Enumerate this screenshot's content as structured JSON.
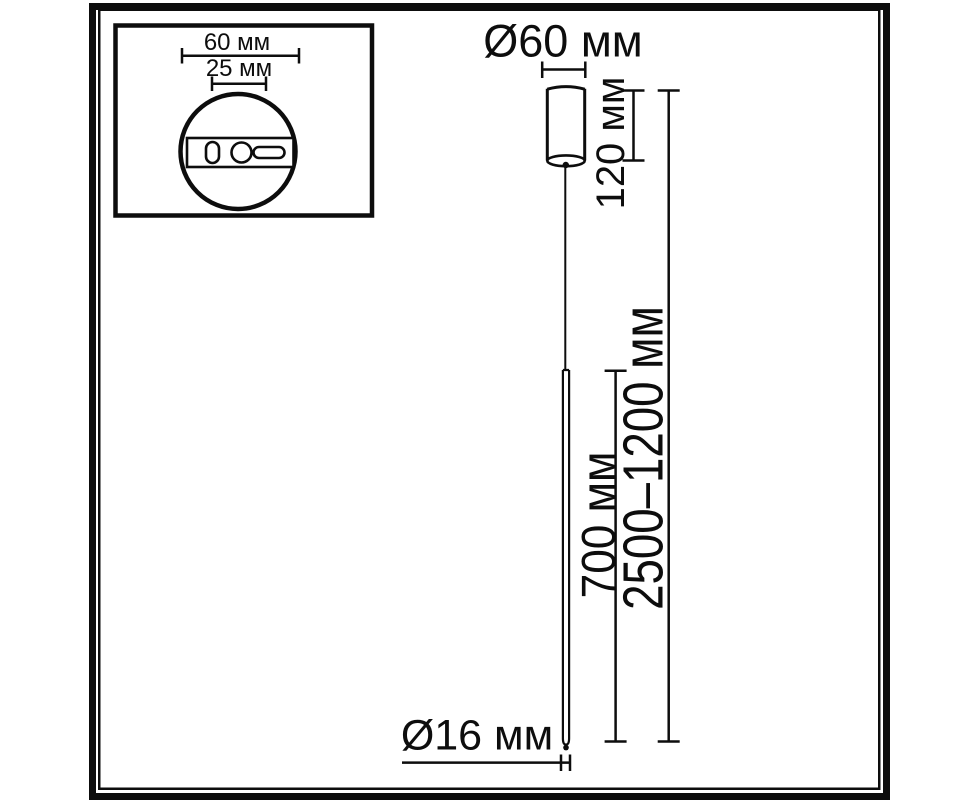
{
  "colors": {
    "ink": "#0d0d0d",
    "background": "#ffffff"
  },
  "detail_inset": {
    "canopy_width_label": "60 мм",
    "mount_hole_spacing_label": "25 мм"
  },
  "dimensions": {
    "canopy_diameter_label": "Ø60 мм",
    "canopy_height_label": "120 мм",
    "suspension_range_label": "2500–1200 мм",
    "tube_length_label": "700 мм",
    "tube_diameter_label": "Ø16 мм"
  }
}
